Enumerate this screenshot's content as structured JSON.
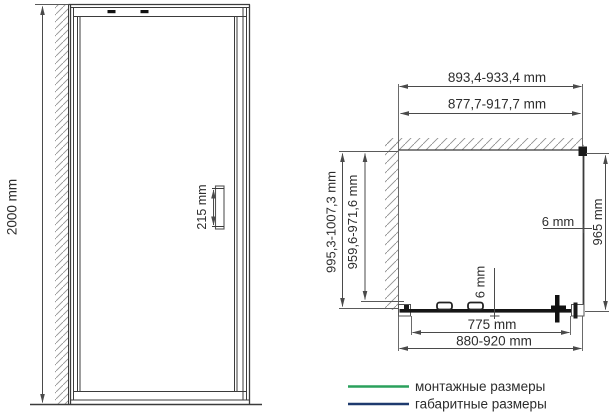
{
  "colors": {
    "mounting_green": "#2aa05c",
    "overall_blue": "#1e3a6e",
    "dim_text": "#2d2d2d",
    "legend_text": "#3f3f3f"
  },
  "front_view": {
    "height_dim": "2000 mm",
    "handle_dim": "215 mm"
  },
  "plan_view": {
    "overall_width_dim": "893,4-933,4 mm",
    "mounting_width_dim": "877,7-917,7 mm",
    "overall_depth_dim": "995,3-1007,3 mm",
    "mounting_depth_dim": "959,6-971,6 mm",
    "side_panel_dim": "965 mm",
    "side_glass_thickness_dim": "6 mm",
    "door_glass_thickness_dim": "6 mm",
    "door_glass_width_dim": "775 mm",
    "adjustment_width_dim": "880-920 mm"
  },
  "legend": {
    "mounting_label": "монтажные размеры",
    "overall_label": "габаритные размеры"
  }
}
